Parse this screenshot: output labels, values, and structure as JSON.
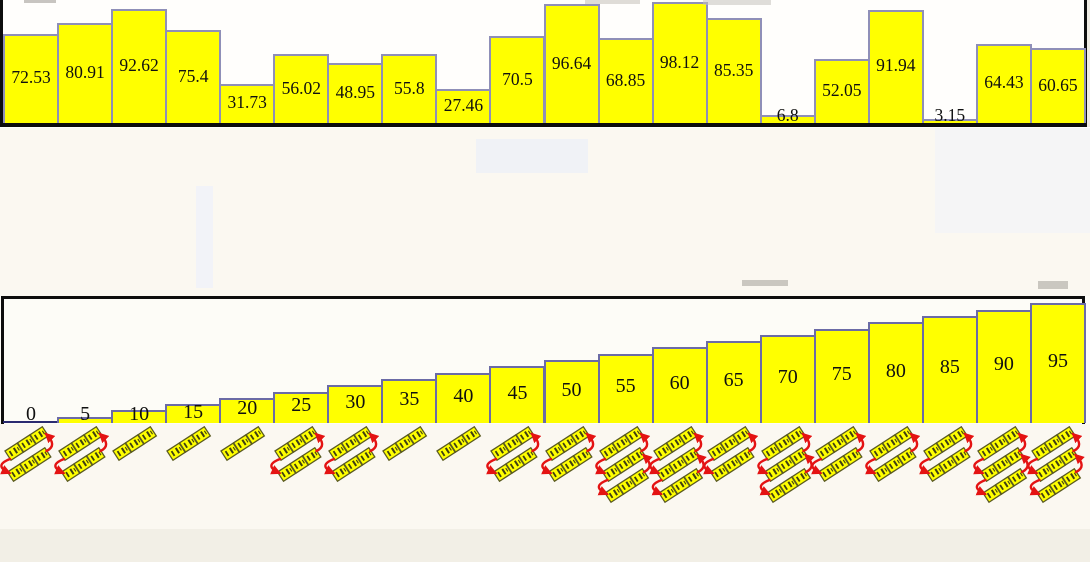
{
  "colors": {
    "background": "#fbf8f1",
    "bar_fill": "#ffff00",
    "bar_border": "#8f8fb8",
    "bar_border_sorted": "#6b6ba6",
    "frame": "#0d0d0d",
    "baseline_sorted": "#2a2a70",
    "label": "#101010",
    "arrow": "#e41313",
    "mini_box_fill": "#ffff00",
    "mini_box_border": "#5a5a20",
    "mini_mark": "#3f3f12"
  },
  "chart_data": [
    {
      "id": "unsorted-array",
      "type": "bar",
      "title": "",
      "values": [
        72.53,
        80.91,
        92.62,
        75.4,
        31.73,
        56.02,
        48.95,
        55.8,
        27.46,
        70.5,
        96.64,
        68.85,
        98.12,
        85.35,
        6.8,
        52.05,
        91.94,
        3.15,
        64.43,
        60.65
      ],
      "ylim": [
        0,
        100
      ],
      "grid": false,
      "legend": false,
      "value_labels": "inside-bars",
      "bar_color": "#ffff00"
    },
    {
      "id": "sorted-array",
      "type": "bar",
      "title": "",
      "values": [
        0,
        5,
        10,
        15,
        20,
        25,
        30,
        35,
        40,
        45,
        50,
        55,
        60,
        65,
        70,
        75,
        80,
        85,
        90,
        95
      ],
      "ylim": [
        0,
        100
      ],
      "grid": false,
      "legend": false,
      "value_labels": "inside-bars",
      "bar_color": "#ffff00"
    }
  ],
  "swap_diagrams": {
    "description": "rotated mini array diagrams of three yellow cells with red cyclic swap arrows, one under each sorted-bar column",
    "units": [
      {
        "rows": 2
      },
      {
        "rows": 2
      },
      {
        "rows": 1
      },
      {
        "rows": 1
      },
      {
        "rows": 1
      },
      {
        "rows": 2
      },
      {
        "rows": 2
      },
      {
        "rows": 1
      },
      {
        "rows": 1
      },
      {
        "rows": 2
      },
      {
        "rows": 2
      },
      {
        "rows": 3
      },
      {
        "rows": 3
      },
      {
        "rows": 2
      },
      {
        "rows": 3
      },
      {
        "rows": 2
      },
      {
        "rows": 2
      },
      {
        "rows": 2
      },
      {
        "rows": 3
      },
      {
        "rows": 3
      }
    ]
  }
}
